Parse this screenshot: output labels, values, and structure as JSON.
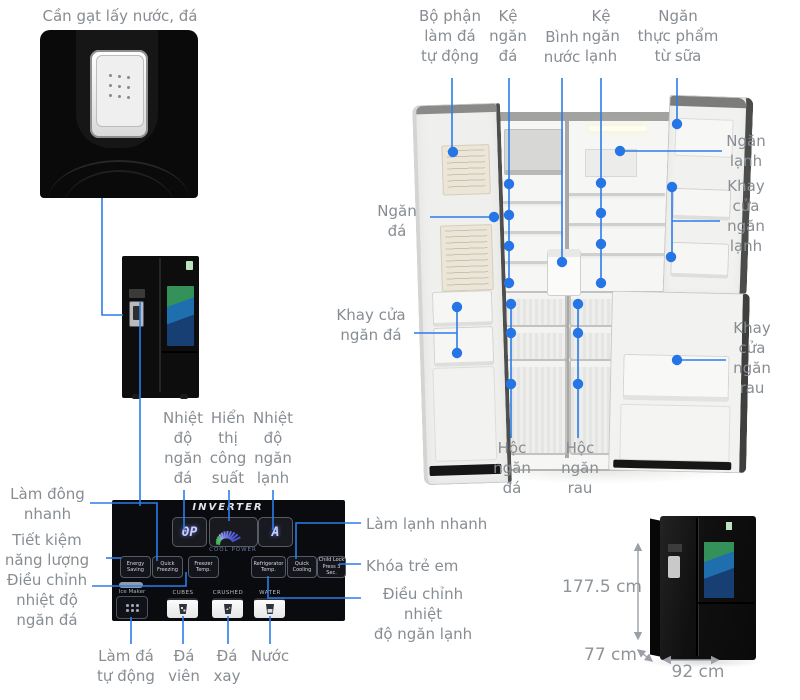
{
  "colors": {
    "accent_blue": "#2b7de9",
    "label_gray": "#878d92",
    "dim_gray": "#9aa0a5"
  },
  "callouts": {
    "dispenser_lever": "Cần gạt lấy nước, đá",
    "auto_ice_unit": "Bộ phận\nlàm đá\ntự động",
    "freezer_shelf": "Kệ\nngăn\nđá",
    "water_tank": "Bình\nnước",
    "fridge_shelf": "Kệ\nngăn\nlạnh",
    "dairy_compartment": "Ngăn\nthực phẩm\ntừ sữa",
    "fridge_compartment": "Ngăn\nlạnh",
    "fridge_door_tray": "Khay\ncửa\nngăn\nlạnh",
    "freezer_compartment": "Ngăn\nđá",
    "freezer_door_tray": "Khay cửa\nngăn đá",
    "veg_door_tray": "Khay\ncửa\nngăn\nrau",
    "freezer_drawer": "Hộc\nngăn\nđá",
    "veg_drawer": "Hộc\nngăn\nrau",
    "freezer_temp_display": "Nhiệt\nđộ\nngăn\nđá",
    "power_display": "Hiển\nthị\ncông\nsuất",
    "fridge_temp_display": "Nhiệt\nđộ\nngăn\nlạnh",
    "quick_freeze": "Làm đông\nnhanh",
    "energy_saving": "Tiết kiệm\nnăng lượng",
    "freezer_temp_adjust": "Điều chỉnh\nnhiệt độ\nngăn đá",
    "quick_cooling": "Làm lạnh nhanh",
    "child_lock": "Khóa trẻ em",
    "fridge_temp_adjust": "Điều chỉnh nhiệt\nđộ ngăn lạnh",
    "auto_ice": "Làm đá\ntự động",
    "ice_cubes": "Đá\nviên",
    "crushed_ice": "Đá\nxay",
    "water": "Nước"
  },
  "panel": {
    "brand": "INVERTER",
    "freezer_display": "0P",
    "fridge_display": "A",
    "cool_power": "COOL POWER",
    "btn_energy_saving": "Energy\nSaving",
    "btn_quick_freezing": "Quick\nFreezing",
    "btn_freezer_temp": "Freezer\nTemp.",
    "btn_refrigerator_temp": "Refrigerator\nTemp.",
    "btn_quick_cooling": "Quick\nCooling",
    "btn_child_lock": "Child Lock\nPress 3 Sec.",
    "ice_maker": "Ice Maker",
    "cubes": "CUBES",
    "crushed": "CRUSHED",
    "water": "WATER"
  },
  "dimensions": {
    "height": "177.5 cm",
    "depth": "77 cm",
    "width": "92 cm"
  }
}
